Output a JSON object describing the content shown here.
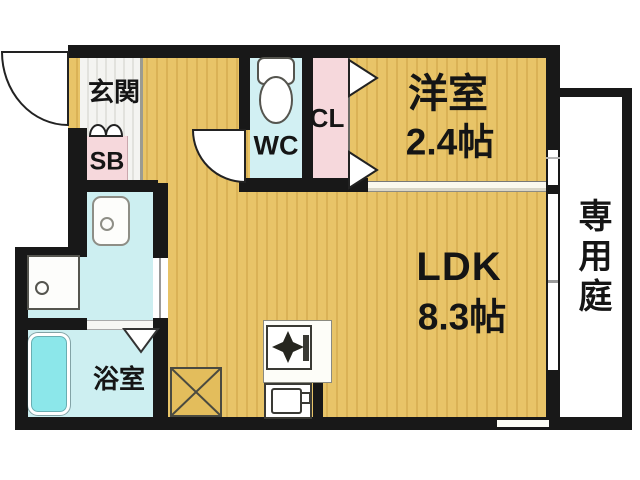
{
  "plan": {
    "type": "apartment-floor-plan",
    "labels": {
      "genkan": "玄関",
      "shoe_box": "SB",
      "wc": "WC",
      "closet": "CL",
      "western_room": "洋室",
      "western_room_size": "2.4帖",
      "ldk": "LDK",
      "ldk_size": "8.3帖",
      "bathroom": "浴室",
      "private_garden": "専用庭"
    },
    "colors": {
      "wall": "#181818",
      "wood_floor": "#e8c468",
      "wood_grain": "#dab256",
      "wet_area": "#cdeff1",
      "bathtub": "#8ce7ea",
      "closet_pink": "#f6d8dc",
      "garden": "#ffffff"
    }
  }
}
